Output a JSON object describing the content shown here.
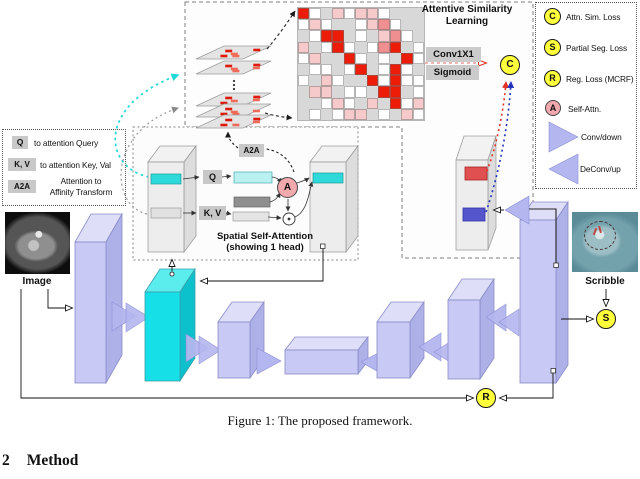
{
  "caption": "Figure 1: The proposed framework.",
  "section": {
    "number": "2",
    "title": "Method"
  },
  "asl": {
    "title_line1": "Attentive Similarity",
    "title_line2": "Learning",
    "conv1x1": "Conv1X1",
    "sigmoid": "Sigmoid",
    "c_node": "C"
  },
  "ssa": {
    "caption_line1": "Spatial Self-Attention",
    "caption_line2": "(showing 1 head)",
    "q_chip": "Q",
    "kv_chip": "K, V",
    "a2a_chip": "A2A",
    "a_node": "A"
  },
  "left_legend": {
    "items": [
      {
        "chip": "Q",
        "label": "to attention Query"
      },
      {
        "chip": "K, V",
        "label": "to attention Key, Val"
      },
      {
        "chip": "A2A",
        "label_line1": "Attention to",
        "label_line2": "Affinity Transform"
      }
    ]
  },
  "right_legend": {
    "items": [
      {
        "symbol": "C",
        "label": "Attn. Sim. Loss"
      },
      {
        "symbol": "S",
        "label": "Partial Seg. Loss"
      },
      {
        "symbol": "R",
        "label": "Reg. Loss (MCRF)"
      },
      {
        "symbol": "A",
        "label": "Self-Attn."
      }
    ],
    "conv_down": "Conv/down",
    "deconv_up": "DeConv/up"
  },
  "io": {
    "input_label": "Image",
    "scribble_label": "Scribble",
    "s_node": "S",
    "r_node": "R"
  },
  "colors": {
    "loss_node": "#ffff3c",
    "attn_node": "#f2a9ad",
    "conv_block": "#c8c9f4",
    "highlight_block": "#17dfe7",
    "heat_red": "#ec1c09",
    "heat_pink": "#f6caca",
    "heat_strong_pink": "#ef8f8f",
    "arrow_red": "#e23222",
    "arrow_blue": "#2333bb",
    "arrow_cyan": "#1fd9d9"
  },
  "attention_matrix": [
    [
      3,
      1,
      0,
      2,
      1,
      2,
      2,
      1,
      0,
      0,
      0
    ],
    [
      1,
      2,
      1,
      0,
      0,
      1,
      2,
      4,
      1,
      0,
      0
    ],
    [
      0,
      1,
      3,
      3,
      0,
      1,
      0,
      2,
      4,
      1,
      0
    ],
    [
      2,
      0,
      1,
      3,
      1,
      0,
      1,
      4,
      3,
      0,
      1
    ],
    [
      1,
      2,
      0,
      0,
      3,
      1,
      0,
      1,
      0,
      3,
      1
    ],
    [
      0,
      1,
      1,
      0,
      1,
      3,
      0,
      1,
      3,
      1,
      0
    ],
    [
      1,
      0,
      2,
      1,
      0,
      0,
      3,
      1,
      3,
      1,
      1
    ],
    [
      0,
      2,
      2,
      0,
      1,
      1,
      0,
      3,
      3,
      0,
      1
    ],
    [
      0,
      0,
      1,
      2,
      1,
      0,
      2,
      0,
      3,
      1,
      2
    ],
    [
      0,
      1,
      0,
      1,
      2,
      2,
      0,
      1,
      0,
      2,
      1
    ]
  ]
}
